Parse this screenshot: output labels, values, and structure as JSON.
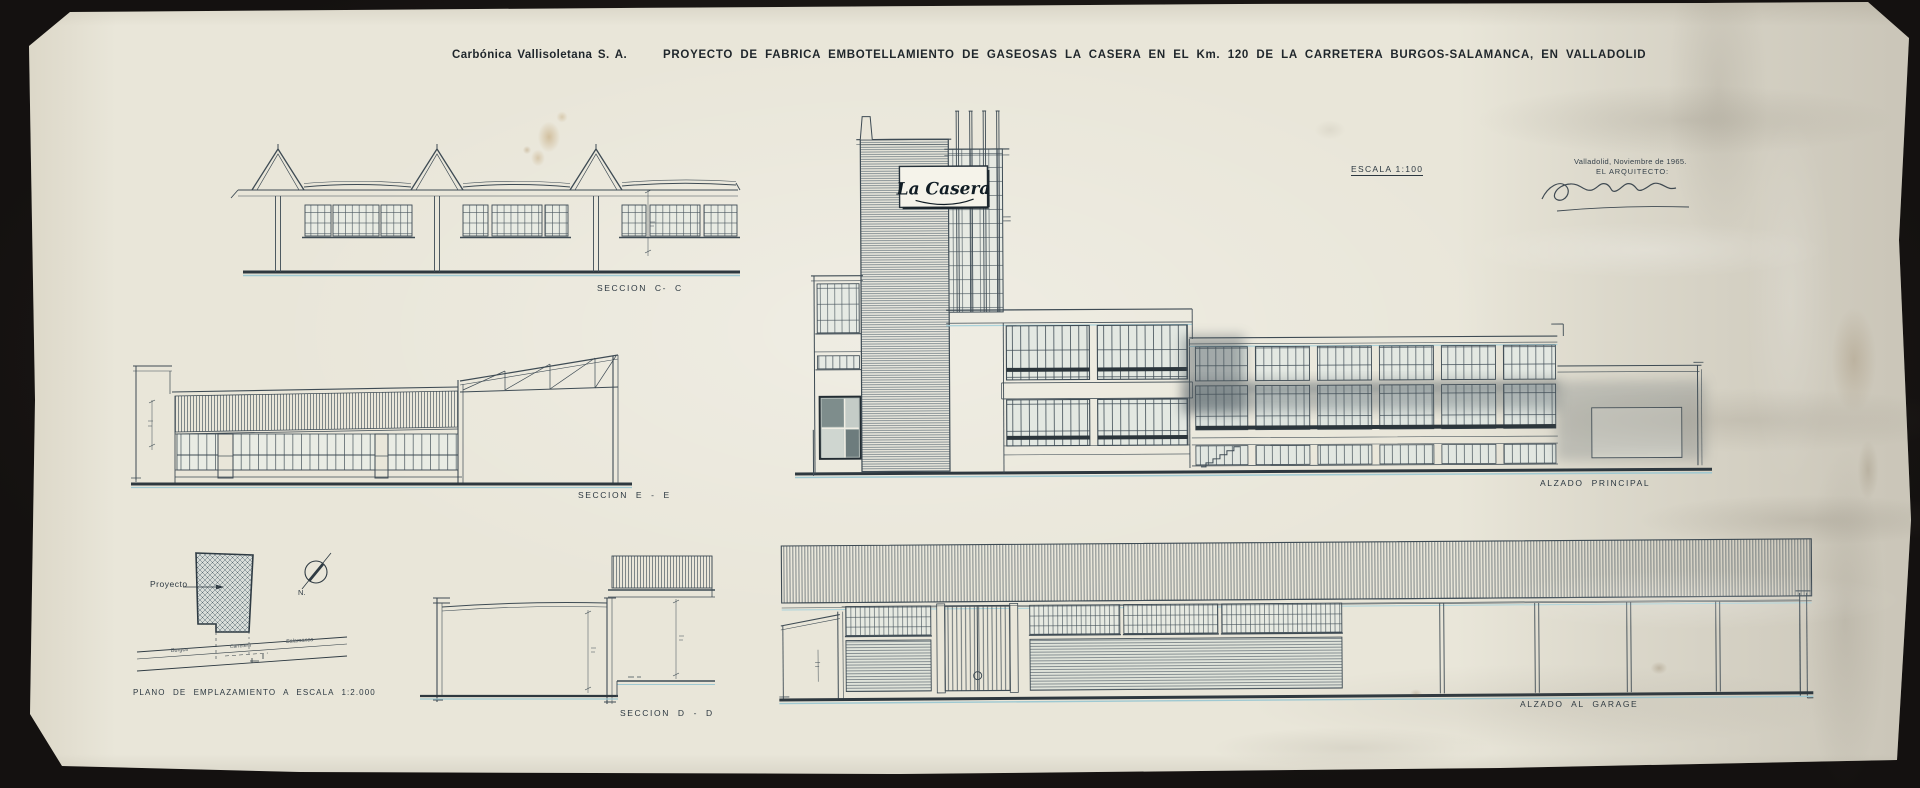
{
  "sheet": {
    "company": "Carbónica Vallisoletana S. A.",
    "title": "PROYECTO DE FABRICA EMBOTELLAMIENTO DE GASEOSAS LA CASERA EN EL Km. 120 DE LA CARRETERA BURGOS-SALAMANCA, EN VALLADOLID",
    "scale_note": "ESCALA 1:100",
    "place_date": "Valladolid, Noviembre de 1965.",
    "architect_line": "EL ARQUITECTO:",
    "brand_sign": "La Casera"
  },
  "labels": {
    "seccion_cc": "SECCION C- C",
    "seccion_ee": "SECCION E - E",
    "site_plan": "PLANO DE EMPLAZAMIENTO A ESCALA 1:2.000",
    "seccion_dd": "SECCION D - D",
    "alzado_principal": "ALZADO PRINCIPAL",
    "alzado_garage": "ALZADO AL GARAGE",
    "project_plot": "Proyecto",
    "north": "N.",
    "road_left": "Burgos",
    "road_center": "Carretera",
    "road_right": "Salamanca"
  },
  "colors": {
    "background": "#16130f",
    "paper": "#e9e6d9",
    "ink": "#3e4b54",
    "ink_dark": "#2b353b",
    "cyan_fringe": "#a9d2da",
    "stain": "#aa7f3e",
    "smudge": "#4a555b"
  }
}
